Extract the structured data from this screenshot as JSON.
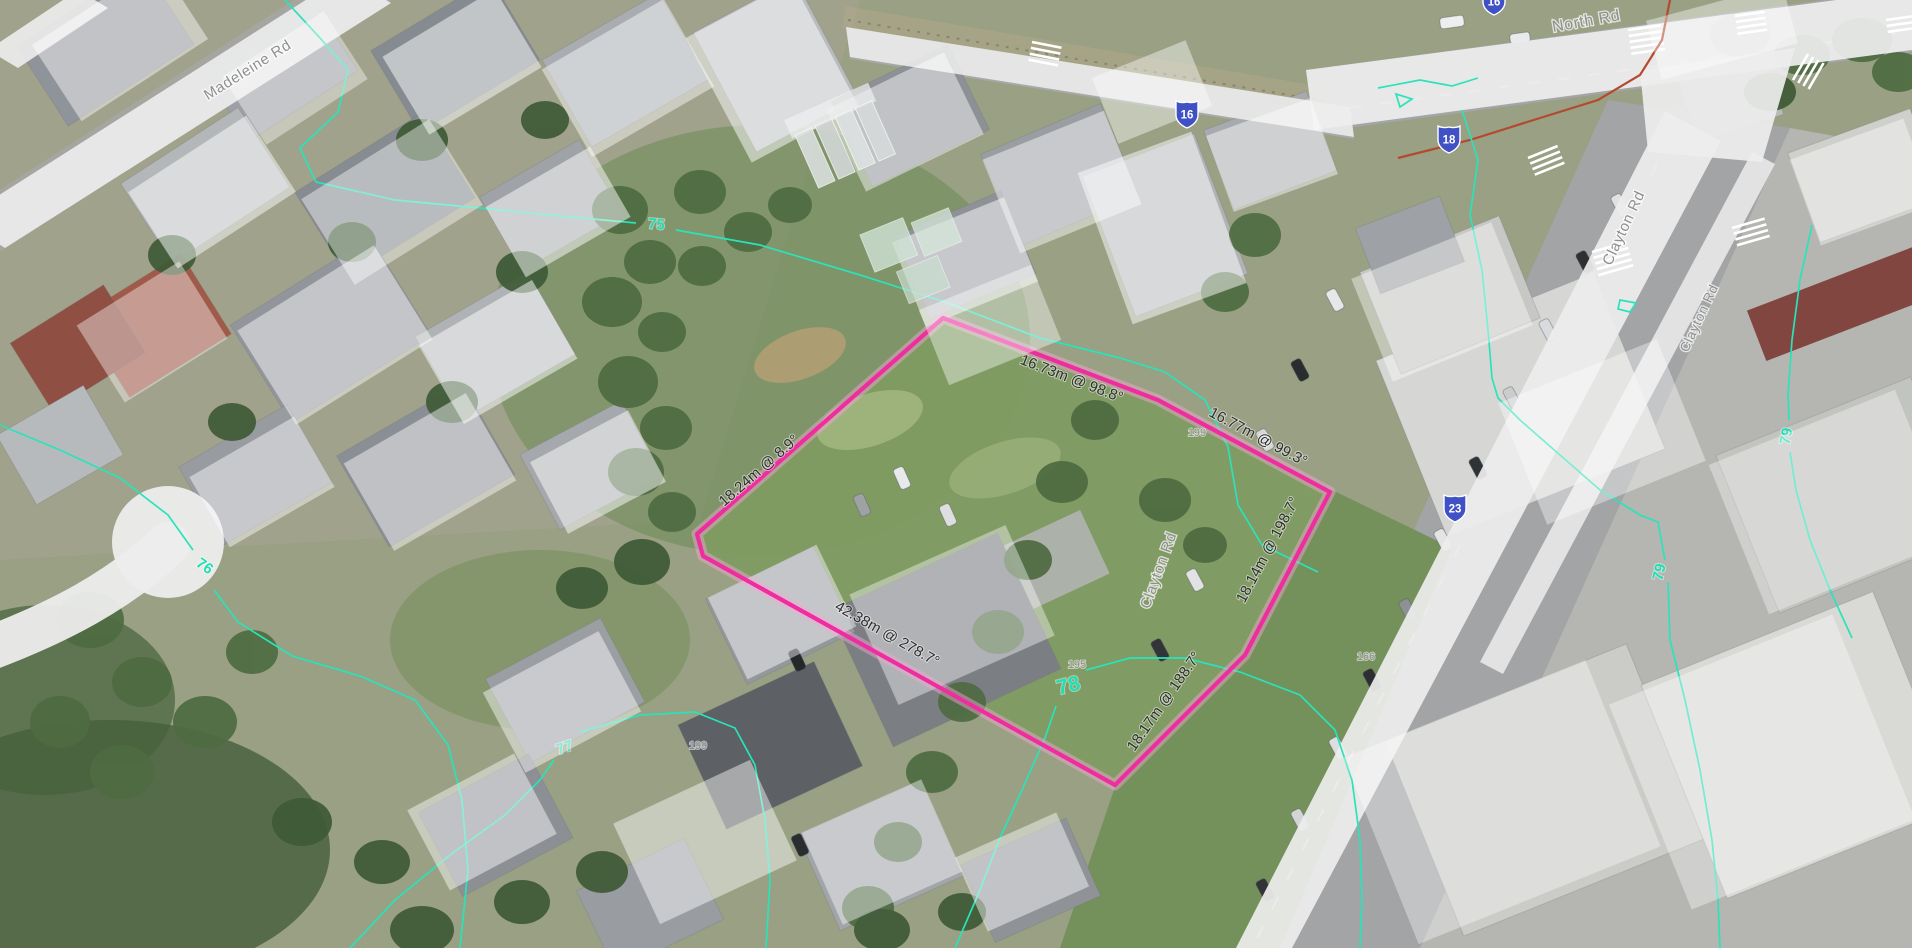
{
  "map": {
    "roads": {
      "madeleine": {
        "label": "Madeleine Rd"
      },
      "north": {
        "label": "North Rd"
      },
      "clayton_upper": {
        "label": "Clayton Rd"
      },
      "clayton_service": {
        "label": "Clayton Rd"
      },
      "clayton_lower": {
        "label": "Clayton Rd"
      }
    },
    "route_shields": {
      "top_cut": "16",
      "north_rd": "16",
      "carinish": "18",
      "clayton": "23"
    },
    "contour_labels": {
      "c75": "75",
      "c76": "76",
      "c77": "77",
      "c78": "78",
      "c79_east": "79",
      "c79_far_east": "79"
    },
    "parcel": {
      "outline_color": "#f02da0",
      "measurements": {
        "west_edge": "18.24m @ 8.9°",
        "north_edge_1": "16.73m @ 98.8°",
        "north_edge_2": "16.77m @ 99.3°",
        "east_edge_1": "18.14m @ 198.7°",
        "east_edge_2": "18.17m @ 188.7°",
        "south_edge": "42.38m @ 278.7°"
      }
    },
    "house_numbers": {
      "n199_east": "199",
      "n195": "195",
      "n166": "166",
      "n199_south": "199"
    },
    "colors": {
      "contour": "#2ae3ba",
      "shield_bg": "#3f51c5",
      "road_label": "#8f8f8f",
      "measurement_text": "#2e2e2e"
    }
  }
}
